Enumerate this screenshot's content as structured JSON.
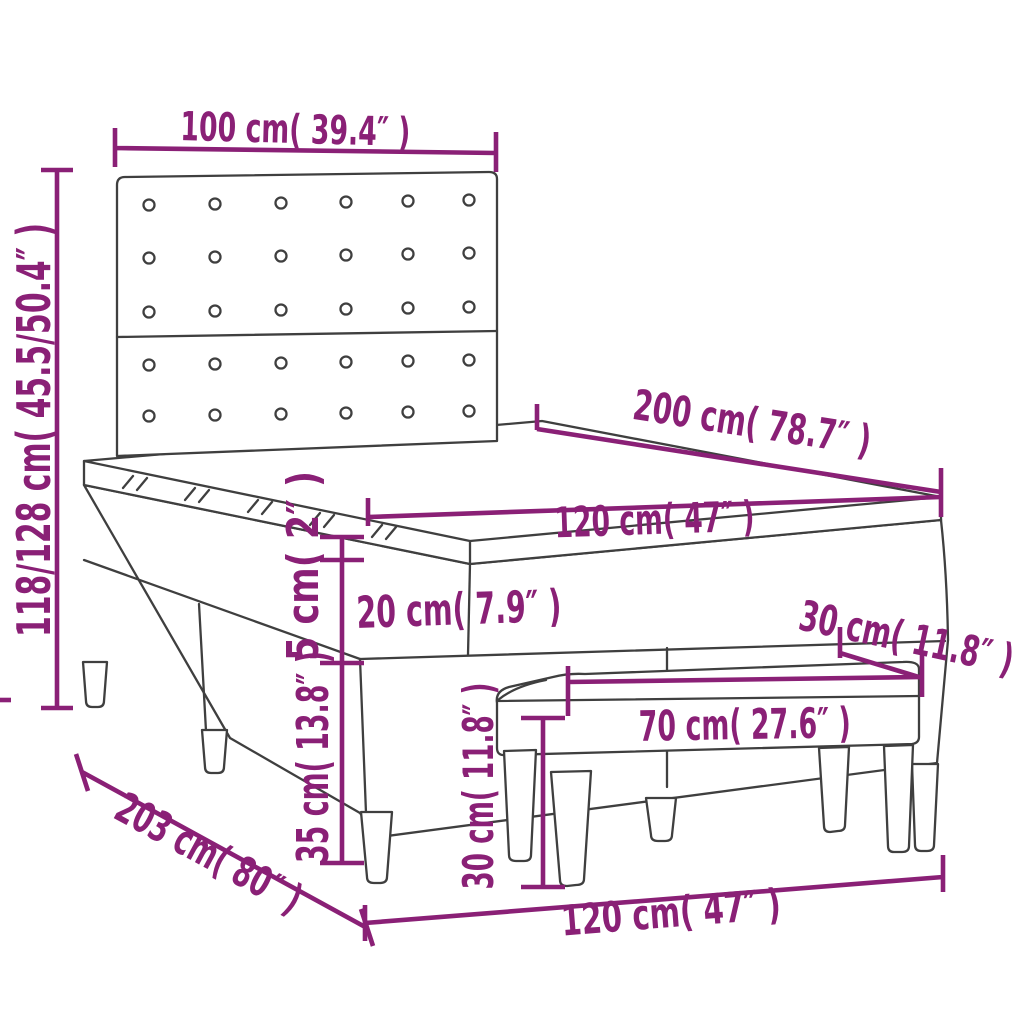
{
  "diagram": {
    "background": "#ffffff",
    "accent_color": "#8a2076",
    "line_color": "#3f3f3f",
    "dimensions": {
      "headboard_width": "100 cm( 39.4″ )",
      "overall_height": "118/128 cm( 45.5/50.4″ )",
      "bed_length": "200 cm( 78.7″ )",
      "mattress_width": "120 cm( 47″ )",
      "topper_height": "5 cm( 2″ )",
      "mattress_height": "20 cm( 7.9″ )",
      "base_height": "35 cm( 13.8″ )",
      "bench_depth": "30 cm( 11.8″ )",
      "bench_length": "70 cm( 27.6″ )",
      "bench_height": "30 cm( 11.8″ )",
      "frame_length": "203 cm( 80″ )",
      "frame_width": "120 cm( 47″ )"
    }
  }
}
